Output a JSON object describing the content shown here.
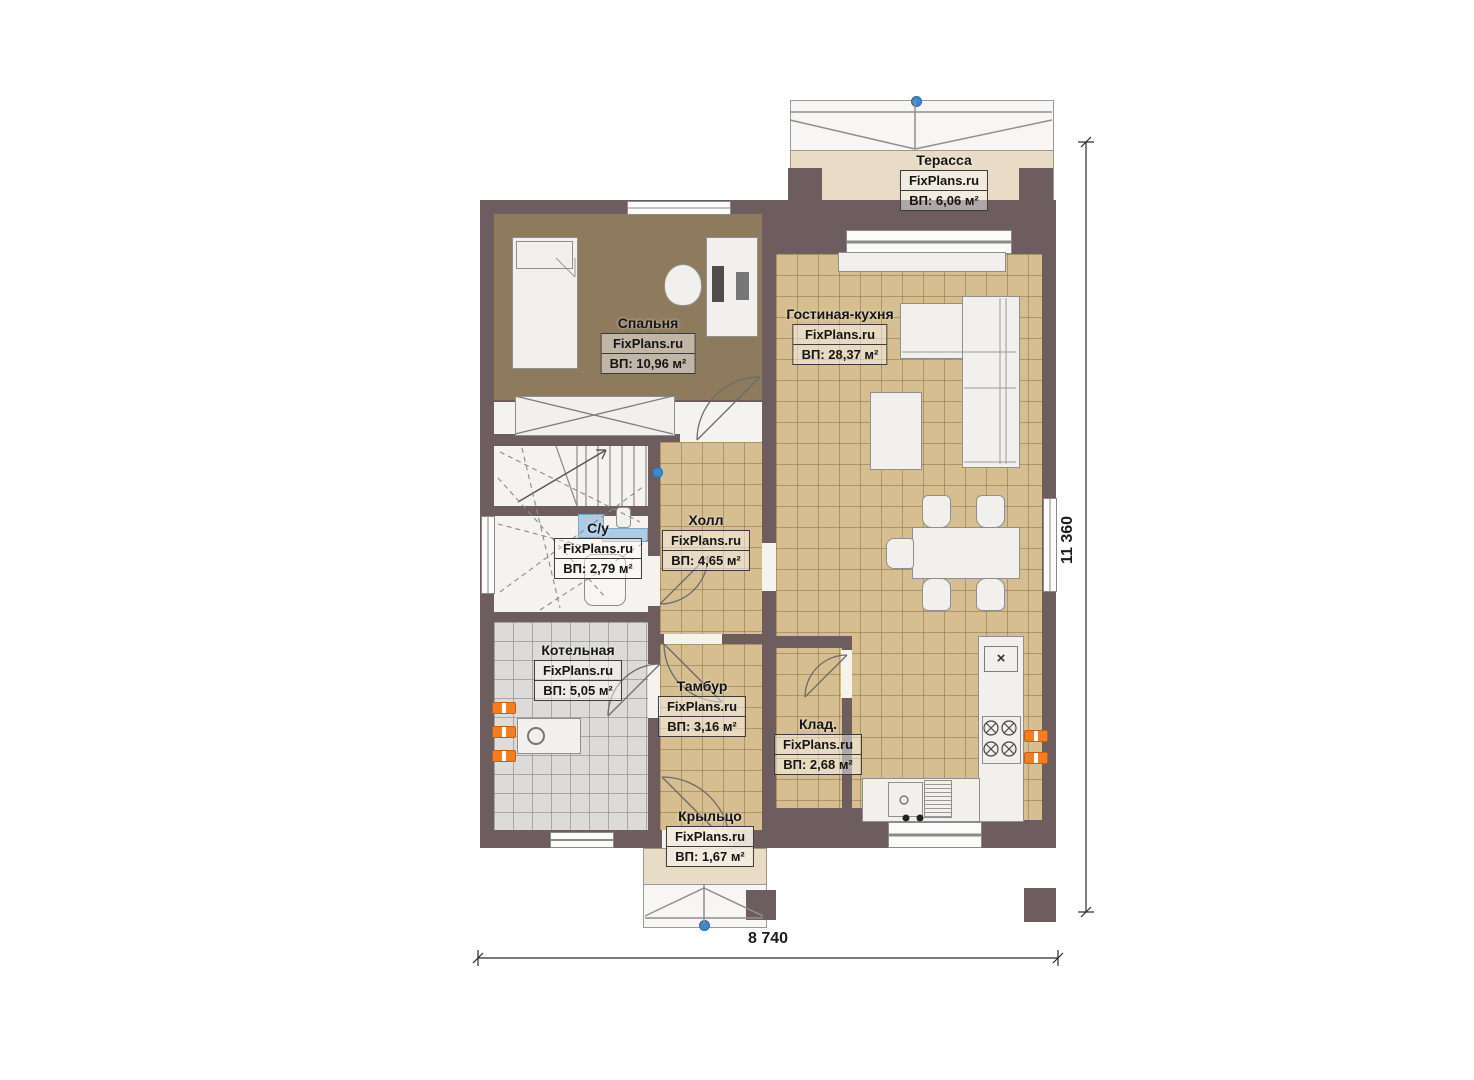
{
  "rooms": [
    {
      "id": "terrace",
      "name": "Терасса",
      "watermark": "FixPlans.ru",
      "area": "ВП: 6,06 м²"
    },
    {
      "id": "bedroom",
      "name": "Спальня",
      "watermark": "FixPlans.ru",
      "area": "ВП: 10,96 м²"
    },
    {
      "id": "living-kitchen",
      "name": "Гостиная-кухня",
      "watermark": "FixPlans.ru",
      "area": "ВП: 28,37 м²"
    },
    {
      "id": "hall",
      "name": "Холл",
      "watermark": "FixPlans.ru",
      "area": "ВП: 4,65 м²"
    },
    {
      "id": "bathroom",
      "name": "С/у",
      "watermark": "FixPlans.ru",
      "area": "ВП: 2,79 м²"
    },
    {
      "id": "boiler-room",
      "name": "Котельная",
      "watermark": "FixPlans.ru",
      "area": "ВП: 5,05 м²"
    },
    {
      "id": "vestibule",
      "name": "Тамбур",
      "watermark": "FixPlans.ru",
      "area": "ВП: 3,16 м²"
    },
    {
      "id": "storage",
      "name": "Клад.",
      "watermark": "FixPlans.ru",
      "area": "ВП: 2,68 м²"
    },
    {
      "id": "porch",
      "name": "Крыльцо",
      "watermark": "FixPlans.ru",
      "area": "ВП: 1,67 м²"
    }
  ],
  "dimensions": {
    "width": "8 740",
    "height": "11 360"
  },
  "symbols": {
    "hob_mark": "×"
  },
  "colors": {
    "wall": "#6e5d5f",
    "tan_floor": "#d6be90",
    "bedroom_floor": "#8e7b5d",
    "gray_floor": "#dcdbd9",
    "terrace_floor": "#e8dcc6",
    "radiator_orange": "#f57d22",
    "fixture_blue": "#aecbe6",
    "marker_blue": "#3f87c9"
  }
}
